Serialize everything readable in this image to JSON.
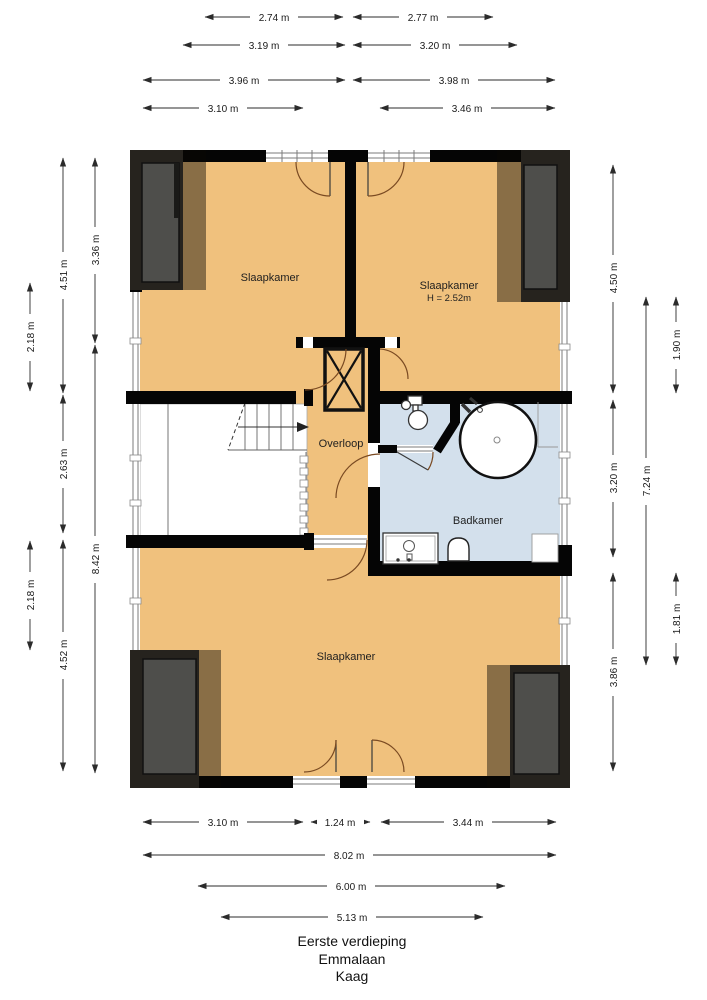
{
  "title_block": {
    "floor": "Eerste verdieping",
    "street": "Emmalaan",
    "city": "Kaag"
  },
  "rooms": {
    "bedroom_top_left": {
      "label": "Slaapkamer"
    },
    "bedroom_top_right": {
      "label": "Slaapkamer",
      "height_note": "H = 2.52m"
    },
    "landing": {
      "label": "Overloop"
    },
    "bathroom": {
      "label": "Badkamer"
    },
    "bedroom_bottom": {
      "label": "Slaapkamer"
    }
  },
  "dimensions": {
    "top": [
      {
        "label": "2.74 m"
      },
      {
        "label": "2.77 m"
      },
      {
        "label": "3.19 m"
      },
      {
        "label": "3.20 m"
      },
      {
        "label": "3.96 m"
      },
      {
        "label": "3.98 m"
      },
      {
        "label": "3.10 m"
      },
      {
        "label": "3.46 m"
      }
    ],
    "bottom": [
      {
        "label": "3.10 m"
      },
      {
        "label": "1.24 m"
      },
      {
        "label": "3.44 m"
      },
      {
        "label": "8.02 m"
      },
      {
        "label": "6.00 m"
      },
      {
        "label": "5.13 m"
      }
    ],
    "left": [
      {
        "label": "3.36 m"
      },
      {
        "label": "8.42 m"
      },
      {
        "label": "4.51 m"
      },
      {
        "label": "2.63 m"
      },
      {
        "label": "4.52 m"
      },
      {
        "label": "2.18 m"
      },
      {
        "label": "2.18 m"
      }
    ],
    "right": [
      {
        "label": "4.50 m"
      },
      {
        "label": "3.20 m"
      },
      {
        "label": "3.86 m"
      },
      {
        "label": "7.24 m"
      },
      {
        "label": "1.90 m"
      },
      {
        "label": "1.81 m"
      }
    ]
  },
  "colors": {
    "floor": "#F0C17D",
    "bathroom_floor": "#D3E0EC",
    "wall": "#000000",
    "roof_zone_dark": "#26231E",
    "roof_zone_grey": "#4E4E4B",
    "door_arc": "#7A4A22"
  }
}
